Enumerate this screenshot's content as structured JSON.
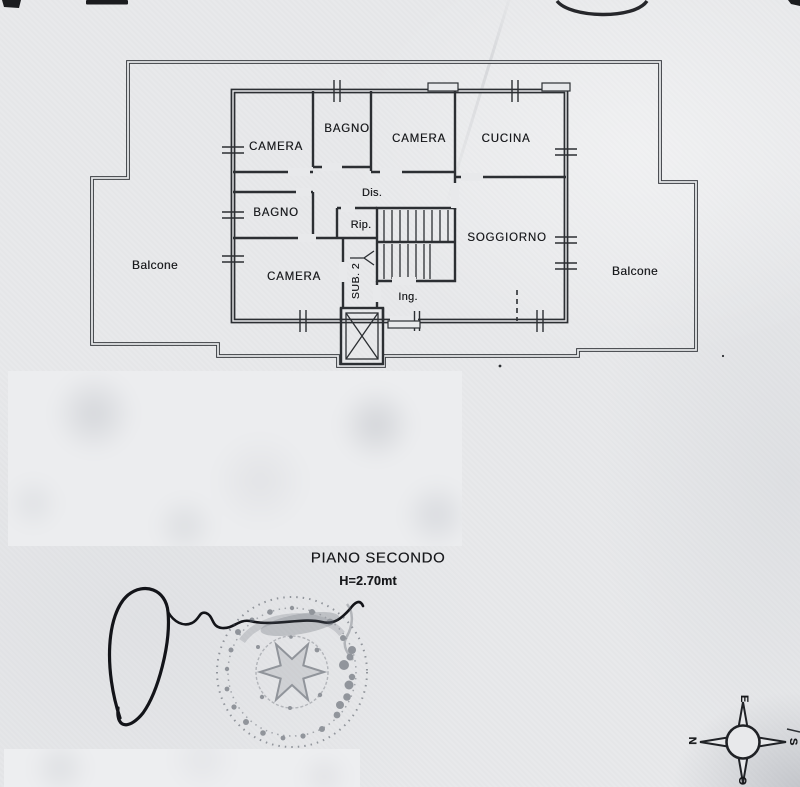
{
  "colors": {
    "paper": "#e8e9eb",
    "ink": "#2c2f33",
    "stamp": "#4e545e"
  },
  "caption": {
    "title": "PIANO SECONDO",
    "height_note": "H=2.70mt"
  },
  "rooms": [
    {
      "id": "camera-top-left",
      "label": "CAMERA"
    },
    {
      "id": "bagno-top",
      "label": "BAGNO"
    },
    {
      "id": "camera-top-middle",
      "label": "CAMERA"
    },
    {
      "id": "cucina",
      "label": "CUCINA"
    },
    {
      "id": "disimpegno",
      "label": "Dis."
    },
    {
      "id": "bagno-middle-left",
      "label": "BAGNO"
    },
    {
      "id": "ripostiglio",
      "label": "Rip."
    },
    {
      "id": "soggiorno",
      "label": "SOGGIORNO"
    },
    {
      "id": "camera-bottom-left",
      "label": "CAMERA"
    },
    {
      "id": "sub-unit",
      "label": "SUB. 2"
    },
    {
      "id": "ingresso",
      "label": "Ing."
    },
    {
      "id": "balcone-left",
      "label": "Balcone"
    },
    {
      "id": "balcone-right",
      "label": "Balcone"
    }
  ],
  "compass": {
    "north": "N",
    "east": "E",
    "south": "S",
    "west": "O"
  },
  "graphics": {
    "stamp": "round-official-stamp",
    "signature": "handwritten-signature",
    "compass": "compass-rose",
    "redactions": "blurred-region"
  }
}
